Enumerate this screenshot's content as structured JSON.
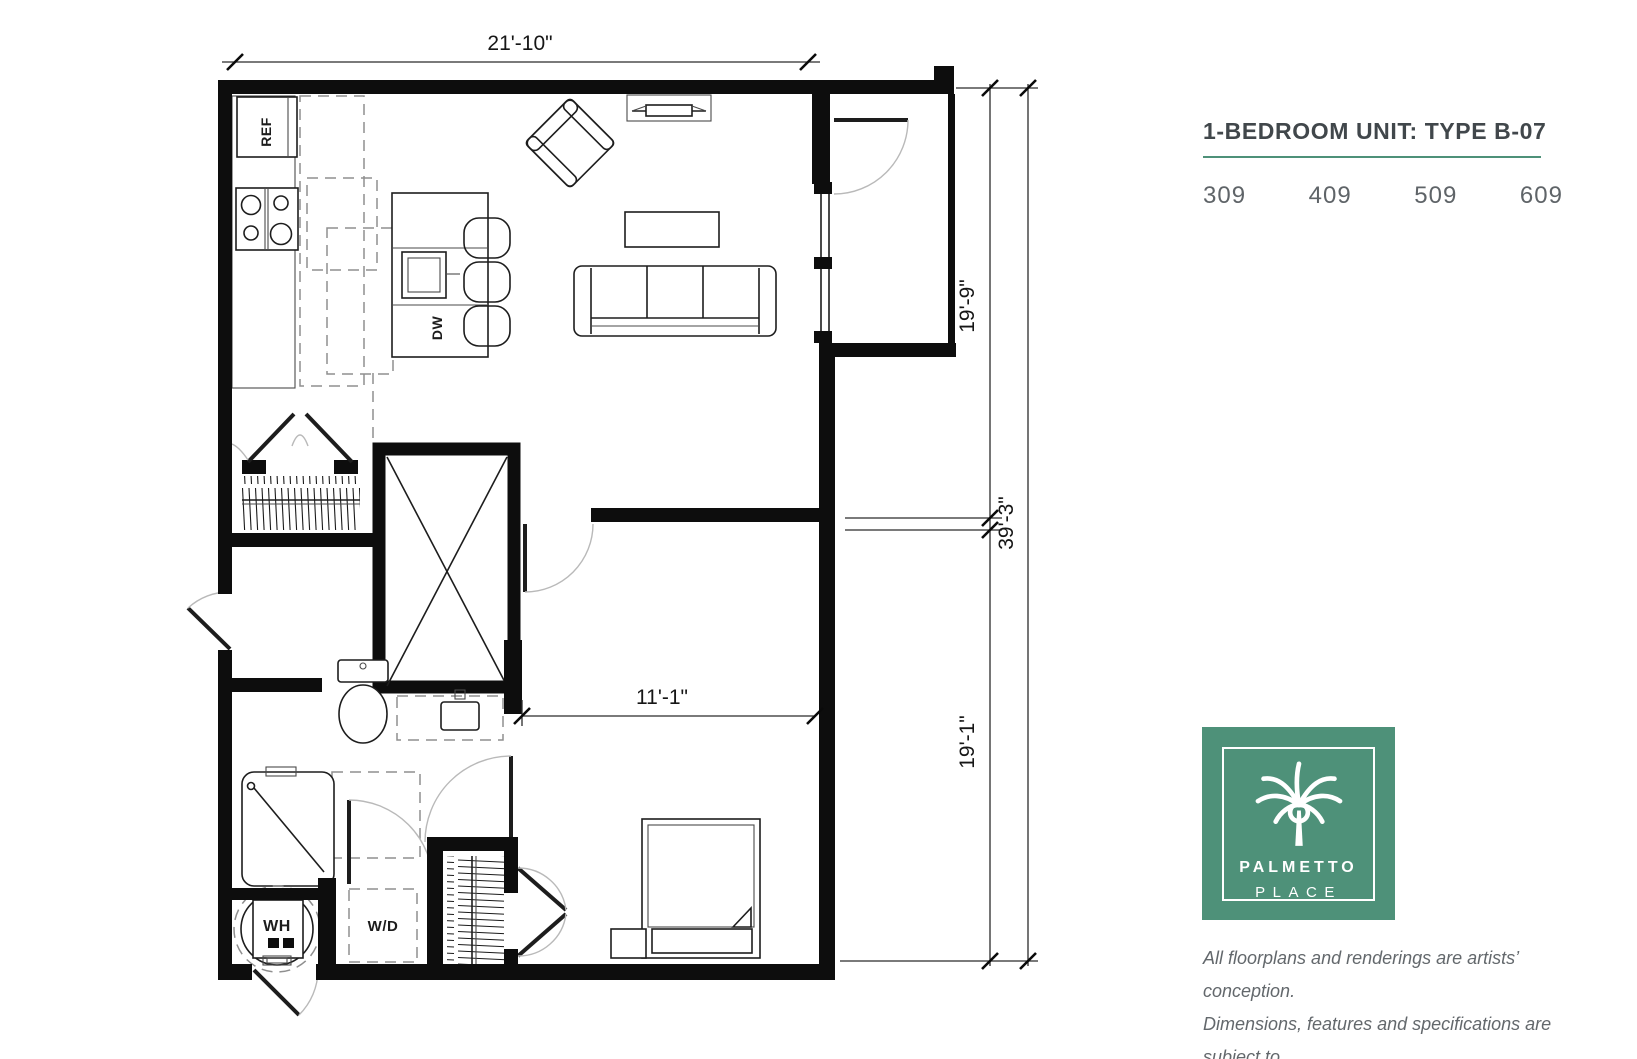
{
  "panel": {
    "title": "1-BEDROOM UNIT: TYPE B-07",
    "units": [
      "309",
      "409",
      "509",
      "609"
    ],
    "disclaimer": [
      "All floorplans and renderings are artists’ conception.",
      "Dimensions, features and specifications are subject to",
      "change at the discretion of the builder."
    ]
  },
  "logo": {
    "name_top": "PALMETTO",
    "name_bottom": "PLACE"
  },
  "colors": {
    "brand_green": "#4E9179",
    "title_text": "#41474B",
    "body_text": "#63686C"
  },
  "floorplan": {
    "dimensions": {
      "top_width": "21'-10\"",
      "right_upper": "19'-9\"",
      "right_overall": "39'-3\"",
      "right_lower": "19'-1\"",
      "bedroom_width": "11'-1\""
    },
    "labels": {
      "refrigerator": "REF",
      "dishwasher": "DW",
      "washer_dryer": "W/D",
      "water_heater": "WH"
    }
  }
}
